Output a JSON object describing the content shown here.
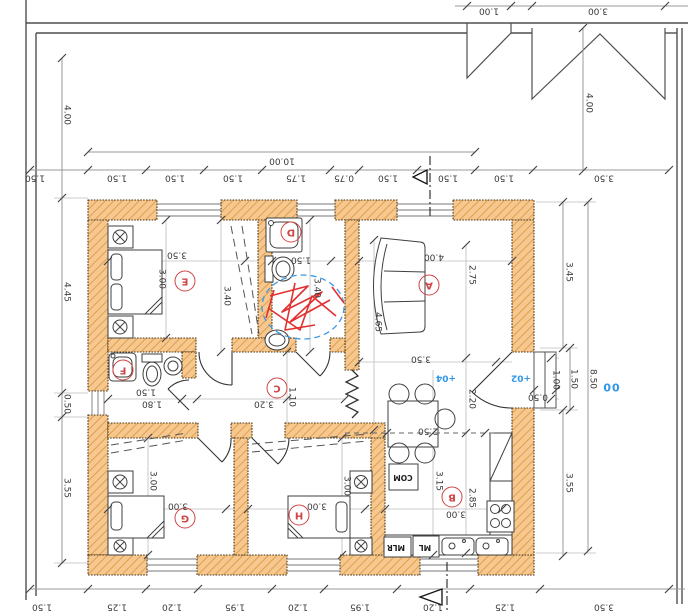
{
  "rooms": [
    {
      "label": "A"
    },
    {
      "label": "B"
    },
    {
      "label": "C"
    },
    {
      "label": "D"
    },
    {
      "label": "E"
    },
    {
      "label": "F"
    },
    {
      "label": "G"
    },
    {
      "label": "H"
    }
  ],
  "dims": {
    "top_outer": [
      "1.00",
      "3.00"
    ],
    "top_total": "10.00",
    "top_chain": [
      "1.50",
      "1.50",
      "1.50",
      "1.50",
      "1.75",
      "0.75",
      "1.50",
      "1.50",
      "1.50",
      "3.50"
    ],
    "bottom_chain": [
      "1.50",
      "1.25",
      "1.20",
      "1.95",
      "1.20",
      "1.95",
      "1.20",
      "1.25",
      "3.50"
    ],
    "left_chain": [
      "4.00",
      "4.45",
      "0.50",
      "3.55"
    ],
    "right_chain": [
      "4.00",
      "3.45",
      "1.00",
      "1.50",
      "8.50",
      "0.50",
      "3.55"
    ],
    "room_e": [
      "3.50",
      "3.00",
      "3.40"
    ],
    "room_d": [
      "1.50",
      "3.40"
    ],
    "room_a": [
      "4.00",
      "2.75",
      "4.65",
      "3.50"
    ],
    "room_f": [
      "1.50",
      "1.80"
    ],
    "corridor_c": [
      "3.20",
      "1.10"
    ],
    "room_g": [
      "3.00",
      "3.00"
    ],
    "room_h": [
      "3.00",
      "3.00"
    ],
    "room_b": [
      "3.00",
      "3.15",
      "2.85",
      "2.20",
      "2.50"
    ]
  },
  "levels": [
    "+04",
    "+02",
    "00"
  ],
  "appliances": [
    "COM",
    "ML",
    "MLR"
  ],
  "colors": {
    "wall_fill": "#f6c88f",
    "wall_hatch": "#dd9a44",
    "room_tag_red": "#cf4444",
    "annotation_red": "#e23030",
    "annotation_blue": "#3d9ae8",
    "level_blue": "#2f97e8",
    "dim_gray": "#999999"
  }
}
